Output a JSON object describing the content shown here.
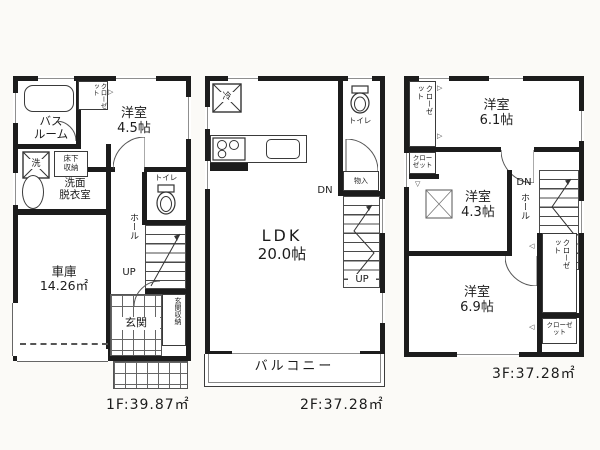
{
  "floor1": {
    "footer": "1F:39.87㎡",
    "rooms": {
      "bathroom": {
        "line1": "バス",
        "line2": "ルーム"
      },
      "closet": "クローゼット",
      "western": {
        "name": "洋室",
        "size": "4.5帖"
      },
      "washer": "洗",
      "underfloor": {
        "line1": "床下",
        "line2": "収納"
      },
      "washroom": {
        "line1": "洗面",
        "line2": "脱衣室"
      },
      "toilet": "トイレ",
      "hall": "ホール",
      "up": "UP",
      "garage": {
        "name": "車庫",
        "size": "14.26㎡"
      },
      "entrance": "玄関",
      "entrance_storage": "玄関収納"
    }
  },
  "floor2": {
    "footer": "2F:37.28㎡",
    "rooms": {
      "refrigerator": "冷",
      "toilet": "トイレ",
      "storage": "物入",
      "ldk": {
        "name": "LDK",
        "size": "20.0帖"
      },
      "dn": "DN",
      "up": "UP",
      "balcony": "バルコニー"
    }
  },
  "floor3": {
    "footer": "3F:37.28㎡",
    "rooms": {
      "closet_left": "クローゼット",
      "closet_left_small": "クローゼット",
      "western_61": {
        "name": "洋室",
        "size": "6.1帖"
      },
      "western_43": {
        "name": "洋室",
        "size": "4.3帖"
      },
      "dn": "DN",
      "hall": "ホール",
      "western_69": {
        "name": "洋室",
        "size": "6.9帖"
      },
      "closet_right": "クローゼット",
      "closet_right_small": "クローゼット"
    }
  },
  "icons": {
    "tri_right": "▷",
    "tri_left": "◁",
    "tri_down": "▽"
  },
  "colors": {
    "wall": "#1c1c1c",
    "line": "#3a3a3a",
    "background": "#fbfaf7"
  }
}
